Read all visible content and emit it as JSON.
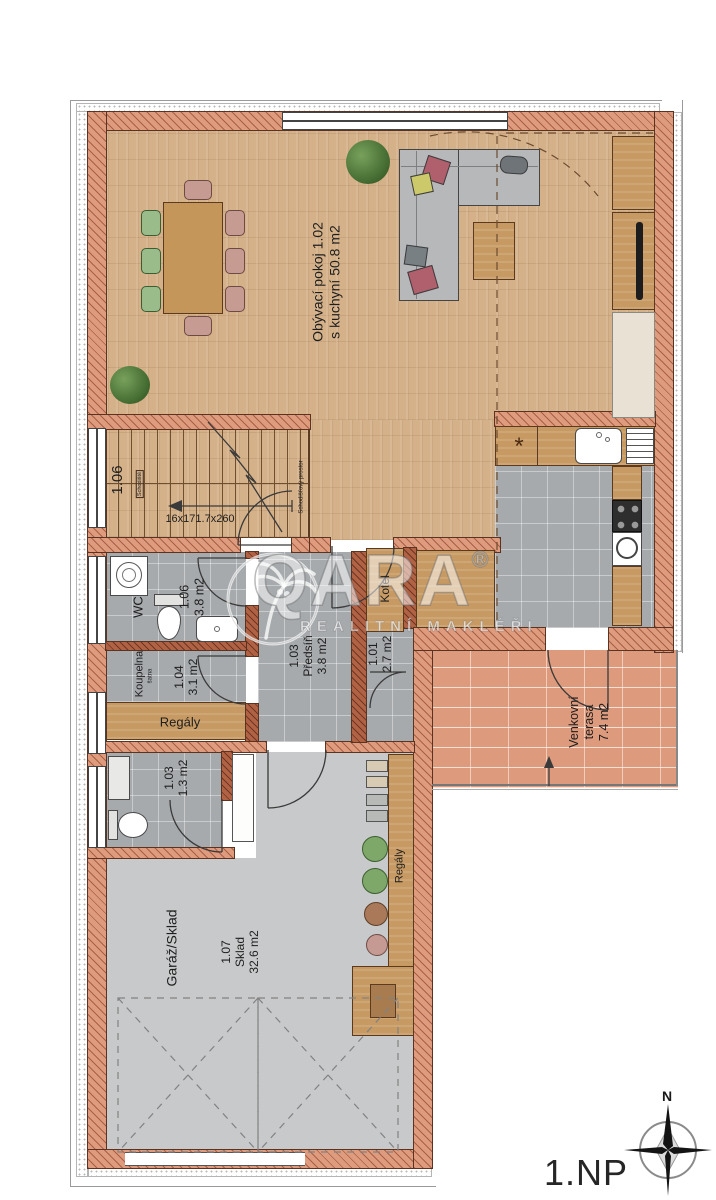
{
  "floor_label": "1.NP",
  "compass": {
    "north": "N"
  },
  "watermark": {
    "brand": "QARA",
    "reg": "®",
    "tagline": "REALITNÍ MAKLÉŘI"
  },
  "palette": {
    "wall": "#df9b7d",
    "wood_floor": "#d5b189",
    "tile_floor": "#a6aaad",
    "concrete_floor": "#c7c9ca",
    "terrace_brick": "#dd9a7c"
  },
  "rooms": {
    "living": {
      "line1": "Obývací pokoj  1.02",
      "line2": "s kuchyní  50.8 m2"
    },
    "stairs": {
      "number": "1.06",
      "steps": "16x171.7x260",
      "note": "Schodiště",
      "note2": "Schodišťový prostor"
    },
    "wc": {
      "name": "WC",
      "number": "1.06",
      "area": "3.8 m2"
    },
    "bathroom": {
      "name": "Koupelna",
      "note": "šatna",
      "number": "1.04",
      "area": "3.1 m2"
    },
    "bath_shelf_label": "Regály",
    "hall": {
      "number": "1.03",
      "name": "Předsíň",
      "area": "3.8 m2"
    },
    "boiler": {
      "equipment": "Kotel",
      "number": "1.01",
      "area": "2.7 m2"
    },
    "kitchen": {
      "hob_marker": "*"
    },
    "terrace": {
      "line1": "Venkovní",
      "line2": "terasa",
      "line3": "7.4 m2"
    },
    "small_wc": {
      "number": "1.03",
      "area": "1.3 m2"
    },
    "garage": {
      "name": "Garáž/Sklad",
      "number": "1.07",
      "type": "Sklad",
      "area": "32.6 m2"
    },
    "garage_shelf_label": "Regály"
  }
}
